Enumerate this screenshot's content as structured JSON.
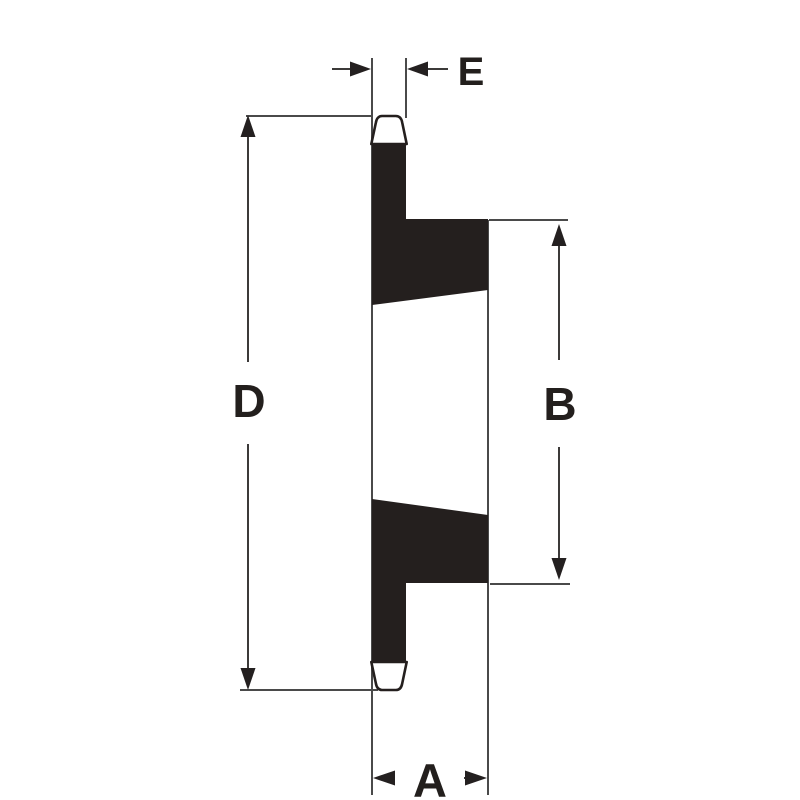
{
  "figure": {
    "kind": "technical-dimension-drawing",
    "dimensions": {
      "e": {
        "label": "E"
      },
      "d": {
        "label": "D"
      },
      "b": {
        "label": "B"
      },
      "a": {
        "label": "A"
      }
    },
    "colors": {
      "background": "#ffffff",
      "part_fill": "#241f1e",
      "thin_line": "#4a4a4a",
      "label_text": "#231f1d"
    }
  }
}
